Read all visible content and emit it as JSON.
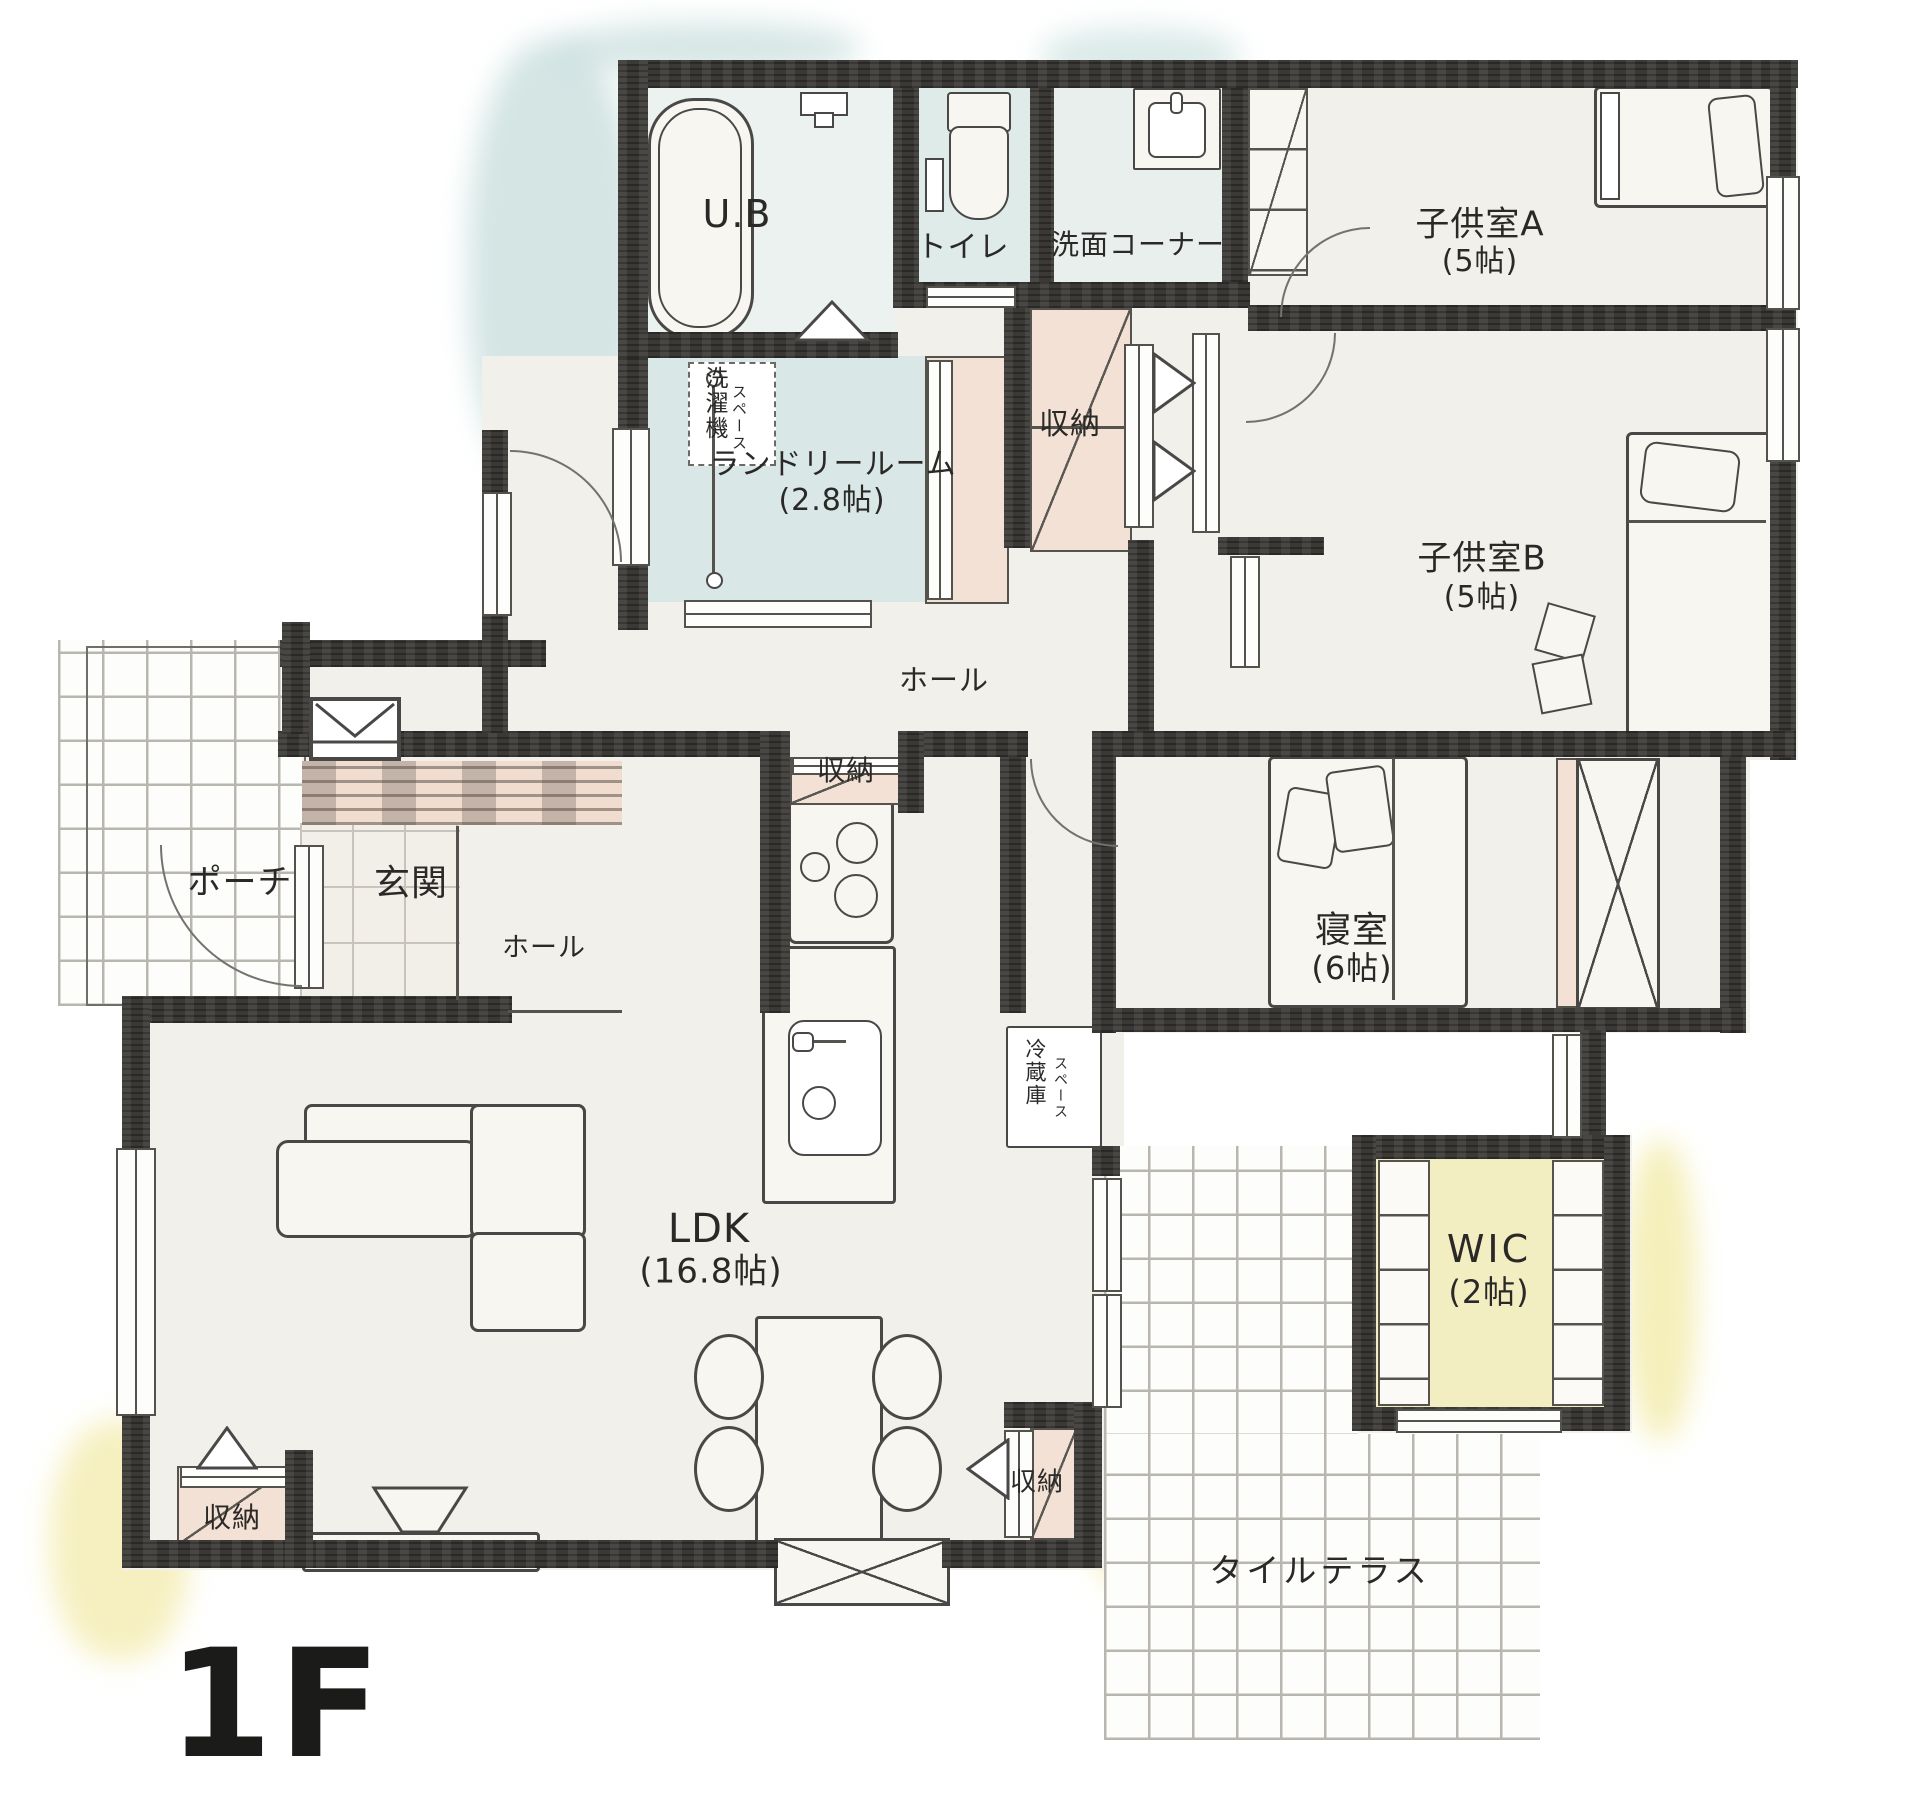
{
  "floor": {
    "label": "1F"
  },
  "rooms": {
    "ub": {
      "label": "U.B"
    },
    "toilet": {
      "label": "トイレ"
    },
    "wash_corner": {
      "label": "洗面コーナー"
    },
    "kids_a": {
      "label": "子供室A",
      "size": "(5帖)"
    },
    "kids_b": {
      "label": "子供室B",
      "size": "(5帖)"
    },
    "laundry": {
      "label": "ランドリールーム",
      "size": "(2.8帖)"
    },
    "hall_upper": {
      "label": "ホール"
    },
    "hall_entry": {
      "label": "ホール"
    },
    "porch": {
      "label": "ポーチ"
    },
    "genkan": {
      "label": "玄関"
    },
    "bedroom": {
      "label": "寝室",
      "size": "(6帖)"
    },
    "ldk": {
      "label": "LDK",
      "size": "(16.8帖)"
    },
    "wic": {
      "label": "WIC",
      "size": "(2帖)"
    },
    "terrace": {
      "label": "タイルテラス"
    }
  },
  "storages": {
    "top": {
      "label": "収納"
    },
    "mid": {
      "label": "収納"
    },
    "bottom_left": {
      "label": "収納"
    },
    "bottom_right": {
      "label": "収納"
    }
  },
  "annotations": {
    "washer": {
      "line1": "洗濯機",
      "line2": "スペース"
    },
    "fridge": {
      "line1": "冷蔵庫",
      "line2": "スペース"
    }
  },
  "colors": {
    "wall": "#3b3936",
    "floor": "#f2f0ea",
    "wet": "#d9e8e6",
    "closet": "#f3e1d5",
    "highlight": "#f3eec2",
    "ink": "#4a4847"
  }
}
